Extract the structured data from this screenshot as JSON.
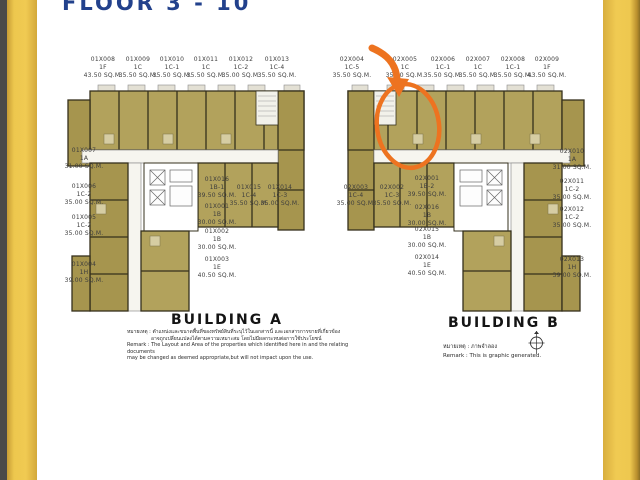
{
  "page": {
    "title": "FLOOR 3 - 10",
    "background": "#ffffff",
    "accent_gold": "#eec84f"
  },
  "annotation": {
    "color": "#ed7320",
    "shape": "hand-drawn-circle-with-arrow",
    "highlight_unit_code": "02X005"
  },
  "compass": {
    "name": "north-compass"
  },
  "buildings": [
    {
      "id": "building-a",
      "name": "BUILDING A",
      "remark_lines": [
        "หมายเหตุ : ตำแหน่งและขนาดพื้นที่ของทรัพย์สินที่ระบุไว้ในเอกสารนี้ และเอกสารการขายที่เกี่ยวข้อง",
        "อาจถูกเปลี่ยนแปลงได้ตามความเหมาะสม โดยไม่มีผลกระทบต่อการใช้ประโยชน์",
        "Remark : The Layout and Area of the properties which identified here in and the relating documents",
        "may be changed as deemed appropriate,but will not impact upon the use."
      ],
      "units": [
        {
          "code": "01X008",
          "type": "1F",
          "area": "43.50 SQ.M.",
          "x": 103,
          "y": 56
        },
        {
          "code": "01X009",
          "type": "1C",
          "area": "35.50 SQ.M.",
          "x": 138,
          "y": 56
        },
        {
          "code": "01X010",
          "type": "1C-1",
          "area": "35.50 SQ.M.",
          "x": 172,
          "y": 56
        },
        {
          "code": "01X011",
          "type": "1C",
          "area": "35.50 SQ.M.",
          "x": 206,
          "y": 56
        },
        {
          "code": "01X012",
          "type": "1C-2",
          "area": "35.00 SQ.M.",
          "x": 241,
          "y": 56
        },
        {
          "code": "01X013",
          "type": "1C-4",
          "area": "35.50 SQ.M.",
          "x": 277,
          "y": 56
        },
        {
          "code": "01X007",
          "type": "1A",
          "area": "31.00 SQ.M.",
          "x": 84,
          "y": 147
        },
        {
          "code": "01X006",
          "type": "1C-2",
          "area": "35.00 SQ.M.",
          "x": 84,
          "y": 183
        },
        {
          "code": "01X005",
          "type": "1C-2",
          "area": "35.00 SQ.M.",
          "x": 84,
          "y": 214
        },
        {
          "code": "01X004",
          "type": "1H",
          "area": "39.00 SQ.M.",
          "x": 84,
          "y": 261
        },
        {
          "code": "01X016",
          "type": "1B-1",
          "area": "39.50 SQ.M.",
          "x": 217,
          "y": 176
        },
        {
          "code": "01X015",
          "type": "1C-4",
          "area": "35.50 SQ.M.",
          "x": 249,
          "y": 184
        },
        {
          "code": "01X014",
          "type": "1C-3",
          "area": "35.00 SQ.M.",
          "x": 280,
          "y": 184
        },
        {
          "code": "01X001",
          "type": "1B",
          "area": "30.00 SQ.M.",
          "x": 217,
          "y": 203
        },
        {
          "code": "01X002",
          "type": "1B",
          "area": "30.00 SQ.M.",
          "x": 217,
          "y": 228
        },
        {
          "code": "01X003",
          "type": "1E",
          "area": "40.50 SQ.M.",
          "x": 217,
          "y": 256
        }
      ]
    },
    {
      "id": "building-b",
      "name": "BUILDING B",
      "remark_lines": [
        "หมายเหตุ : ภาพจำลอง",
        "Remark : This is graphic generated."
      ],
      "units": [
        {
          "code": "02X004",
          "type": "1C-5",
          "area": "35.50 SQ.M.",
          "x": 352,
          "y": 56
        },
        {
          "code": "02X005",
          "type": "1C",
          "area": "35.00 SQ.M.",
          "x": 405,
          "y": 56
        },
        {
          "code": "02X006",
          "type": "1C-1",
          "area": "35.50 SQ.M.",
          "x": 443,
          "y": 56
        },
        {
          "code": "02X007",
          "type": "1C",
          "area": "35.50 SQ.M.",
          "x": 478,
          "y": 56
        },
        {
          "code": "02X008",
          "type": "1C-1",
          "area": "35.50 SQ.M.",
          "x": 513,
          "y": 56
        },
        {
          "code": "02X009",
          "type": "1F",
          "area": "43.50 SQ.M.",
          "x": 547,
          "y": 56
        },
        {
          "code": "02X003",
          "type": "1C-4",
          "area": "35.00 SQ.M.",
          "x": 356,
          "y": 184
        },
        {
          "code": "02X002",
          "type": "1C-3",
          "area": "35.50 SQ.M.",
          "x": 392,
          "y": 184
        },
        {
          "code": "02X001",
          "type": "1B-2",
          "area": "39.50 SQ.M.",
          "x": 427,
          "y": 175
        },
        {
          "code": "02X016",
          "type": "1B",
          "area": "30.00 SQ.M.",
          "x": 427,
          "y": 204
        },
        {
          "code": "02X015",
          "type": "1B",
          "area": "30.00 SQ.M.",
          "x": 427,
          "y": 226
        },
        {
          "code": "02X014",
          "type": "1E",
          "area": "40.50 SQ.M.",
          "x": 427,
          "y": 254
        },
        {
          "code": "02X010",
          "type": "1A",
          "area": "31.00 SQ.M.",
          "x": 572,
          "y": 148
        },
        {
          "code": "02X011",
          "type": "1C-2",
          "area": "35.00 SQ.M.",
          "x": 572,
          "y": 178
        },
        {
          "code": "02X012",
          "type": "1C-2",
          "area": "35.00 SQ.M.",
          "x": 572,
          "y": 206
        },
        {
          "code": "02X013",
          "type": "1H",
          "area": "39.00 SQ.M.",
          "x": 572,
          "y": 256
        }
      ]
    }
  ]
}
